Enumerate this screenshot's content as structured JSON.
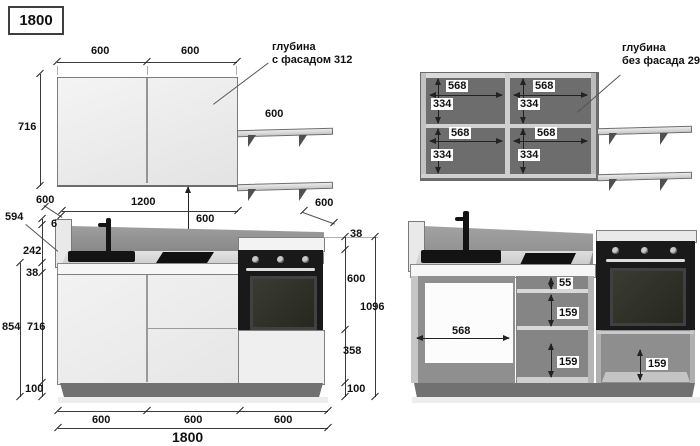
{
  "drawing": {
    "title": "1800",
    "notes": {
      "depth_with_facade_1": "глубина",
      "depth_with_facade_2": "с фасадом 312",
      "depth_without_facade_1": "глубина",
      "depth_without_facade_2": "без фасада 296"
    },
    "wall_front": {
      "door_w1": "600",
      "door_w2": "600",
      "height": "716",
      "shelf_w": "600",
      "gap_below": "600"
    },
    "wall_interior": {
      "inner_w": "568",
      "shelf_gap": "334"
    },
    "base_front": {
      "panel_depth": "594",
      "trim": "6",
      "splash_h": "242",
      "top_thick": "38",
      "counter_h": "854",
      "cab_h": "716",
      "plinth_h": "100",
      "top_w1": "600",
      "top_w2": "1200",
      "oven_w": "600",
      "oven_top": "38",
      "oven_h": "600",
      "oven_drawer": "358",
      "oven_plinth": "100",
      "total_h": "1096",
      "bottom_w": [
        "600",
        "600",
        "600"
      ],
      "total_w": "1800"
    },
    "base_interior": {
      "opening_w": "568",
      "drawer_top": "55",
      "drawer_1": "159",
      "drawer_2": "159",
      "oven_drawer": "159"
    },
    "colors": {
      "line": "#333333",
      "cabinet_face": "#ececec",
      "interior_dark": "#6d6d6d",
      "appliance_black": "#1a1a1a"
    }
  }
}
